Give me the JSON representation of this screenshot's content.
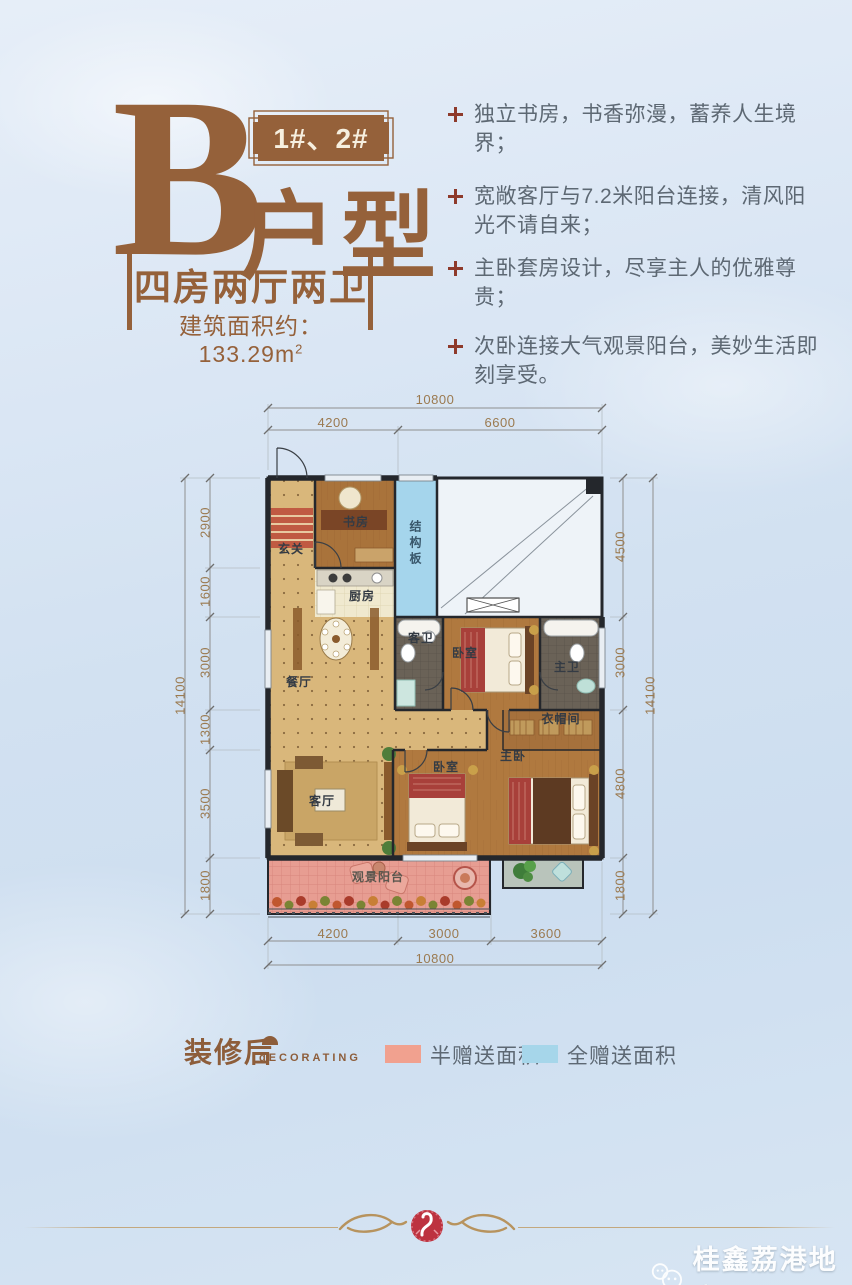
{
  "page": {
    "background_top": "#e0eaf6",
    "background_bottom": "#cfdff0"
  },
  "header": {
    "unit_letter": "B",
    "building_badge": "1#、2#",
    "type_label": "户型",
    "layout_label": "四房两厅两卫",
    "area_label": "建筑面积约：133.29m",
    "area_superscript": "2",
    "accent_color": "#95613a"
  },
  "features": {
    "bullet_color": "#8e3a2b",
    "items": [
      "独立书房，书香弥漫，蓄养人生境界；",
      "宽敞客厅与7.2米阳台连接，清风阳光不请自来；",
      "主卧套房设计，尽享主人的优雅尊贵；",
      "次卧连接大气观景阳台，美妙生活即刻享受。"
    ]
  },
  "floor_plan": {
    "rooms": {
      "entry": "玄关",
      "study": "书房",
      "structural_slab": "结构板",
      "kitchen": "厨房",
      "dining": "餐厅",
      "guest_bath": "客卫",
      "bedroom_middle": "卧室",
      "master_bath": "主卫",
      "closet": "衣帽间",
      "living": "客厅",
      "bedroom_second": "卧室",
      "master_bedroom": "主卧",
      "view_balcony": "观景阳台"
    },
    "dims": {
      "top_total": "10800",
      "top_left": "4200",
      "top_right": "6600",
      "bottom_left": "4200",
      "bottom_middle": "3000",
      "bottom_right": "3600",
      "bottom_total": "10800",
      "left_total": "14100",
      "left_segments": [
        "2900",
        "1600",
        "3000",
        "1300",
        "3500",
        "1800"
      ],
      "right_segments": [
        "4500",
        "3000",
        "4800",
        "1800"
      ],
      "right_total": "14100"
    }
  },
  "legend": {
    "title": "装修后",
    "subtitle": "dECORATING",
    "items": [
      {
        "label": "半赠送面积",
        "color": "#f1a18f"
      },
      {
        "label": "全赠送面积",
        "color": "#a6d6ea"
      }
    ]
  },
  "footer": {
    "watermark_text": "桂鑫荔港地产"
  }
}
